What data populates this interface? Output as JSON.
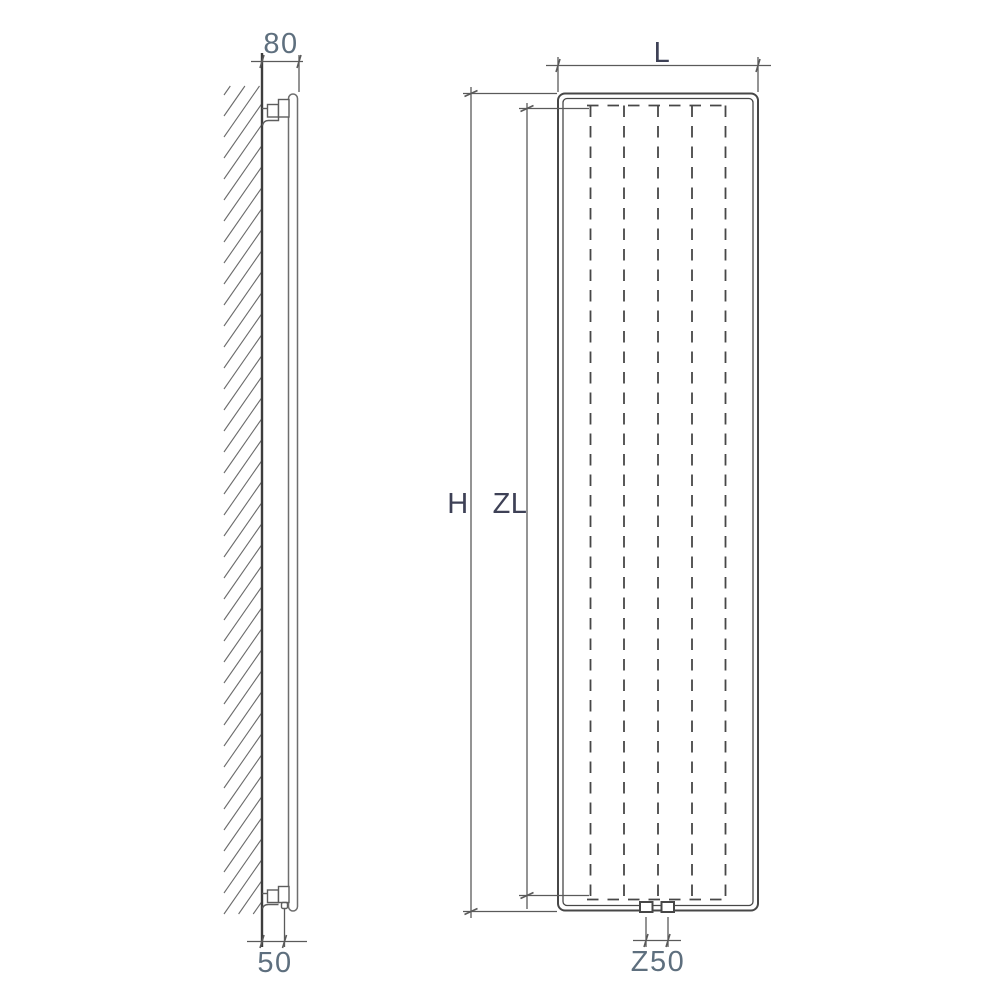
{
  "labels": {
    "depth_top": "80",
    "wall_clearance_bottom": "50",
    "width": "L",
    "height": "H",
    "element_height": "ZL",
    "connection_spacing": "Z50"
  },
  "colors": {
    "line": "#474747",
    "dim-line": "#5a5a5a",
    "side-line": "#6e6e6e",
    "number-text": "#5e6f7e",
    "letter-text": "#3e4156",
    "bg": "#ffffff"
  }
}
